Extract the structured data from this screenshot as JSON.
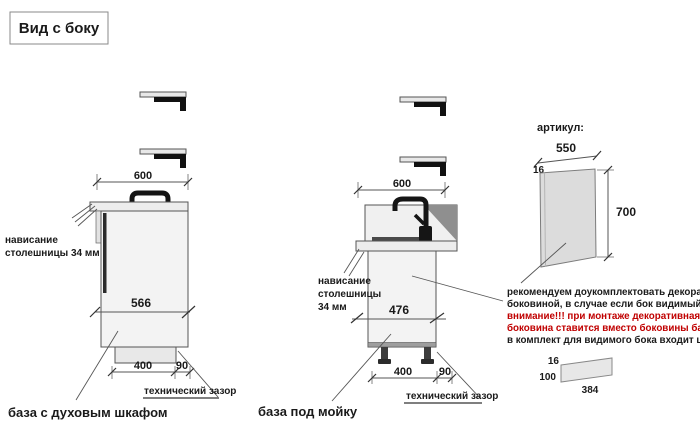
{
  "title_box": {
    "label": "Вид с боку"
  },
  "cabinet_oven": {
    "dim_width": "600",
    "dim_depth": "566",
    "dim_plinth": "400",
    "dim_gap": "90",
    "overhang_line1": "нависание",
    "overhang_line2": "столешницы 34 мм",
    "gap_label": "технический зазор",
    "caption": "база с духовым шкафом"
  },
  "cabinet_sink": {
    "dim_width": "600",
    "dim_depth": "476",
    "dim_plinth": "400",
    "dim_gap": "90",
    "overhang_line1": "нависание",
    "overhang_line2": "столешницы",
    "overhang_line3": "34 мм",
    "gap_label": "технический зазор",
    "caption": "база под мойку"
  },
  "side_panel": {
    "heading": "артикул:",
    "dim_width": "550",
    "dim_thickness": "16",
    "dim_height": "700",
    "note_line1": "рекомендуем доукомплектовать декоративной",
    "note_line2": "боковиной, в случае если бок видимый",
    "warn_line1": "внимание!!! при монтаже декоративная",
    "warn_line2": "боковина ставится вместо боковины базы лдсп",
    "note_line3": "в комплект для видимого бока входит цоколь:"
  },
  "plinth_item": {
    "dim_thickness": "16",
    "dim_height": "100",
    "dim_length": "384"
  },
  "colors": {
    "warning_text": "#c00000",
    "drawing_line": "#555555",
    "fill_light": "#f3f3f3",
    "fill_counter": "#ededed",
    "fill_panel": "#dcdcdc",
    "fill_dark": "#1a1a1a"
  }
}
